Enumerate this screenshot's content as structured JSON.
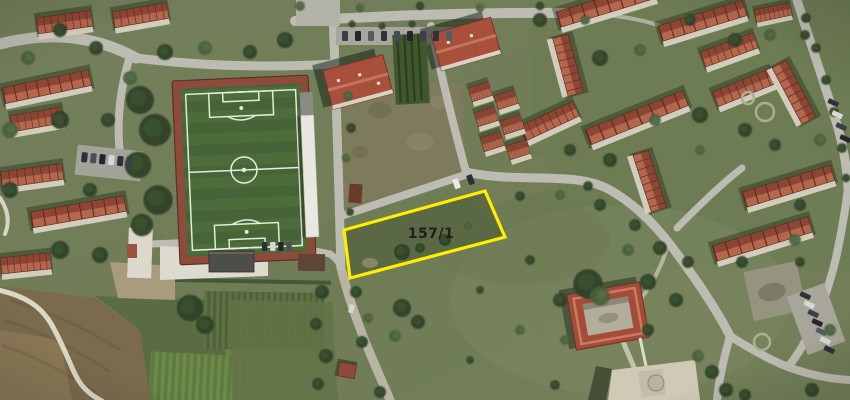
{
  "map": {
    "view": "aerial-satellite",
    "parcel": {
      "label": "157/1",
      "points": "344,230 485,191 505,237 350,278",
      "outline_color": "#ffee00",
      "outline_width": 3.2,
      "label_color": "#1e1e1e"
    },
    "palette": {
      "terrain": "#75815b",
      "road": "#bdbcb2",
      "pitch": "#4b6b3b",
      "track": "#8c4a3a",
      "roof": "#9b5543",
      "tree": "#2f4529",
      "dirt": "#7e7a5c"
    }
  }
}
